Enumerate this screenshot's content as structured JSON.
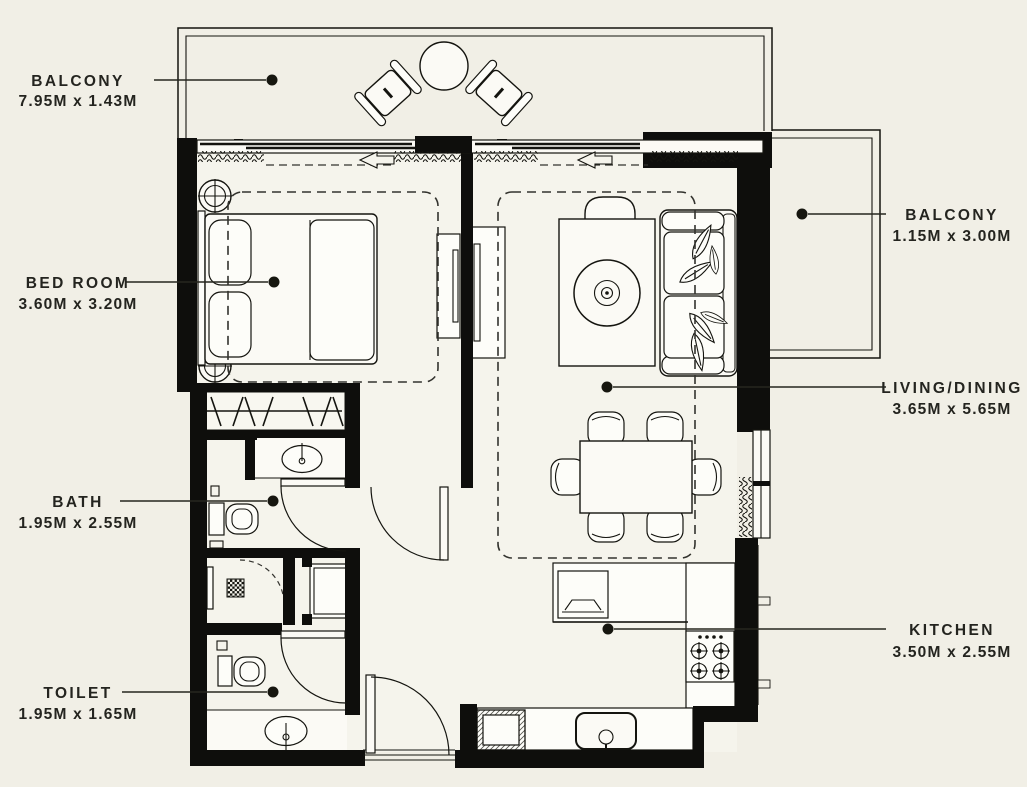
{
  "page": {
    "background_color": "#f1efe6",
    "line_color": "#0e0e0c",
    "label_color": "#24241f"
  },
  "rooms": {
    "balcony_top": {
      "name": "BALCONY",
      "dims": "7.95M x 1.43M"
    },
    "bedroom": {
      "name": "BED ROOM",
      "dims": "3.60M x 3.20M"
    },
    "bath": {
      "name": "BATH",
      "dims": "1.95M x 2.55M"
    },
    "toilet": {
      "name": "TOILET",
      "dims": "1.95M x 1.65M"
    },
    "balcony_right": {
      "name": "BALCONY",
      "dims": "1.15M x 3.00M"
    },
    "living_dining": {
      "name": "LIVING/DINING",
      "dims": "3.65M x 5.65M"
    },
    "kitchen": {
      "name": "KITCHEN",
      "dims": "3.50M x 2.55M"
    }
  }
}
